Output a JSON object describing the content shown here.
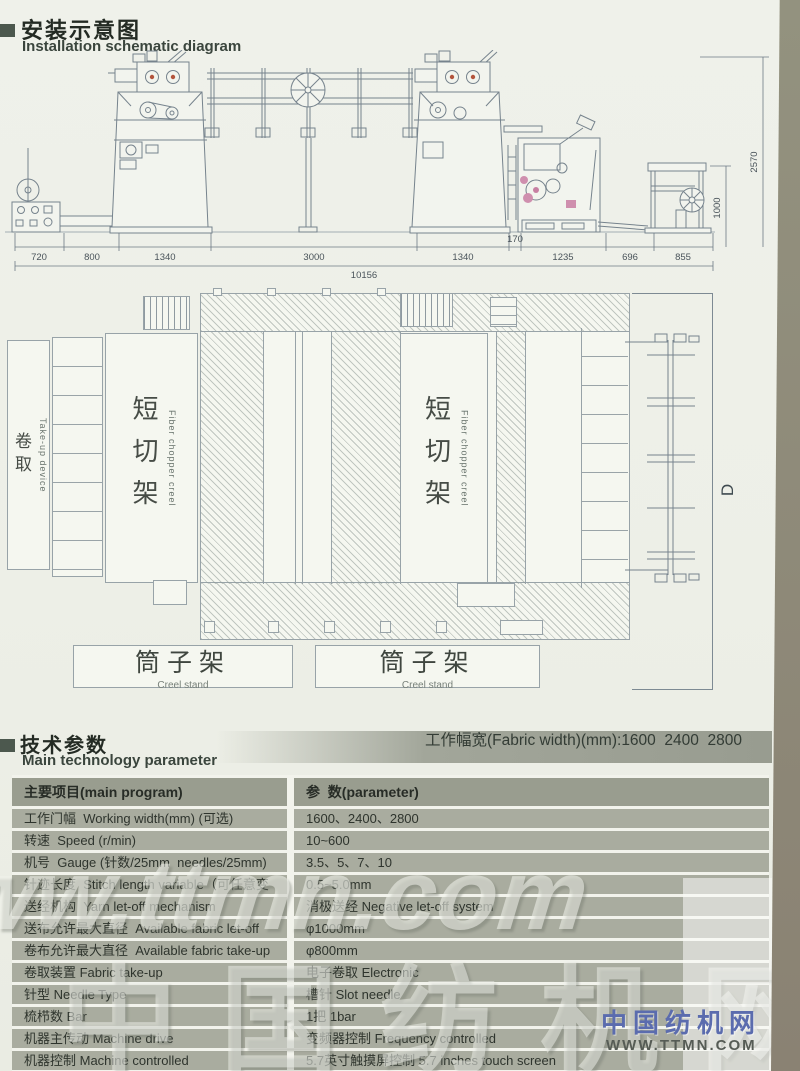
{
  "section_install": {
    "title_zh": "安装示意图",
    "title_en": "Installation schematic diagram"
  },
  "schematic": {
    "dims_bottom": [
      "720",
      "800",
      "1340",
      "3000",
      "1340",
      "170",
      "1235",
      "696",
      "855"
    ],
    "dim_total": "10156",
    "dim_right_height": "2570",
    "dim_right_inner": "1000"
  },
  "topview": {
    "takeup_zh": "卷取",
    "takeup_en": "Take-up device",
    "chopper1_zh": "短切架",
    "chopper1_en": "Fiber chopper creel",
    "chopper2_zh": "短切架",
    "chopper2_en": "Fiber chopper creel",
    "creel1_zh": "筒子架",
    "creel1_en": "Creel stand",
    "creel2_zh": "筒子架",
    "creel2_en": "Creel stand",
    "dim_d_label": "D"
  },
  "size_notes": {
    "line1": "工作幅宽(Fabric width)(mm):1600  2400  2800",
    "line2_prefix": "机器宽度(Machine size)",
    "line2_bold": "D",
    "line2_suffix": "(mm):5800  6600  7000"
  },
  "section_params": {
    "title_zh": "技术参数",
    "title_en": "Main technology parameter"
  },
  "table": {
    "header_name": "主要项目(main program)",
    "header_value": "参  数(parameter)",
    "rows": [
      [
        "工作门幅  Working width(mm) (可选)",
        "1600、2400、2800"
      ],
      [
        "转速  Speed (r/min)",
        "10~600"
      ],
      [
        "机号  Gauge (针数/25mm  needles/25mm)",
        "3.5、5、7、10"
      ],
      [
        "针迹长度  Stitch length variable（可任意变动）",
        "0.5~5.0mm"
      ],
      [
        "送经机构  Yarn let-off mechanism",
        "消极送经 Negative let-off system"
      ],
      [
        "送布允许最大直径  Available fabric let-off diameter(mm)",
        "φ1000mm"
      ],
      [
        "卷布允许最大直径  Available fabric take-up diameter(mm)",
        "φ800mm"
      ],
      [
        "卷取装置 Fabric take-up",
        "电子卷取 Electronic"
      ],
      [
        "针型 Needle Type",
        "槽针 Slot needle"
      ],
      [
        "梳栉数 Bar",
        "1把 1bar"
      ],
      [
        "机器主传动 Machine drive",
        "变频器控制 Frequency controlled"
      ],
      [
        "机器控制 Machine controlled",
        "5.7英寸触摸屏控制 5.7 inches touch screen"
      ],
      [
        "网络远程控制",
        "Controlled by network"
      ]
    ]
  },
  "watermarks": {
    "big_url": "www.ttmn.com",
    "big_cn": "中国纺机网",
    "logo_cn": "中国纺机网",
    "logo_url": "WWW.TTMN.COM"
  },
  "colors": {
    "accent_dark": "#4c584e",
    "table_row": "#a9ac9f",
    "table_header": "#999d8f",
    "logo_blue": "#5b6cae"
  }
}
